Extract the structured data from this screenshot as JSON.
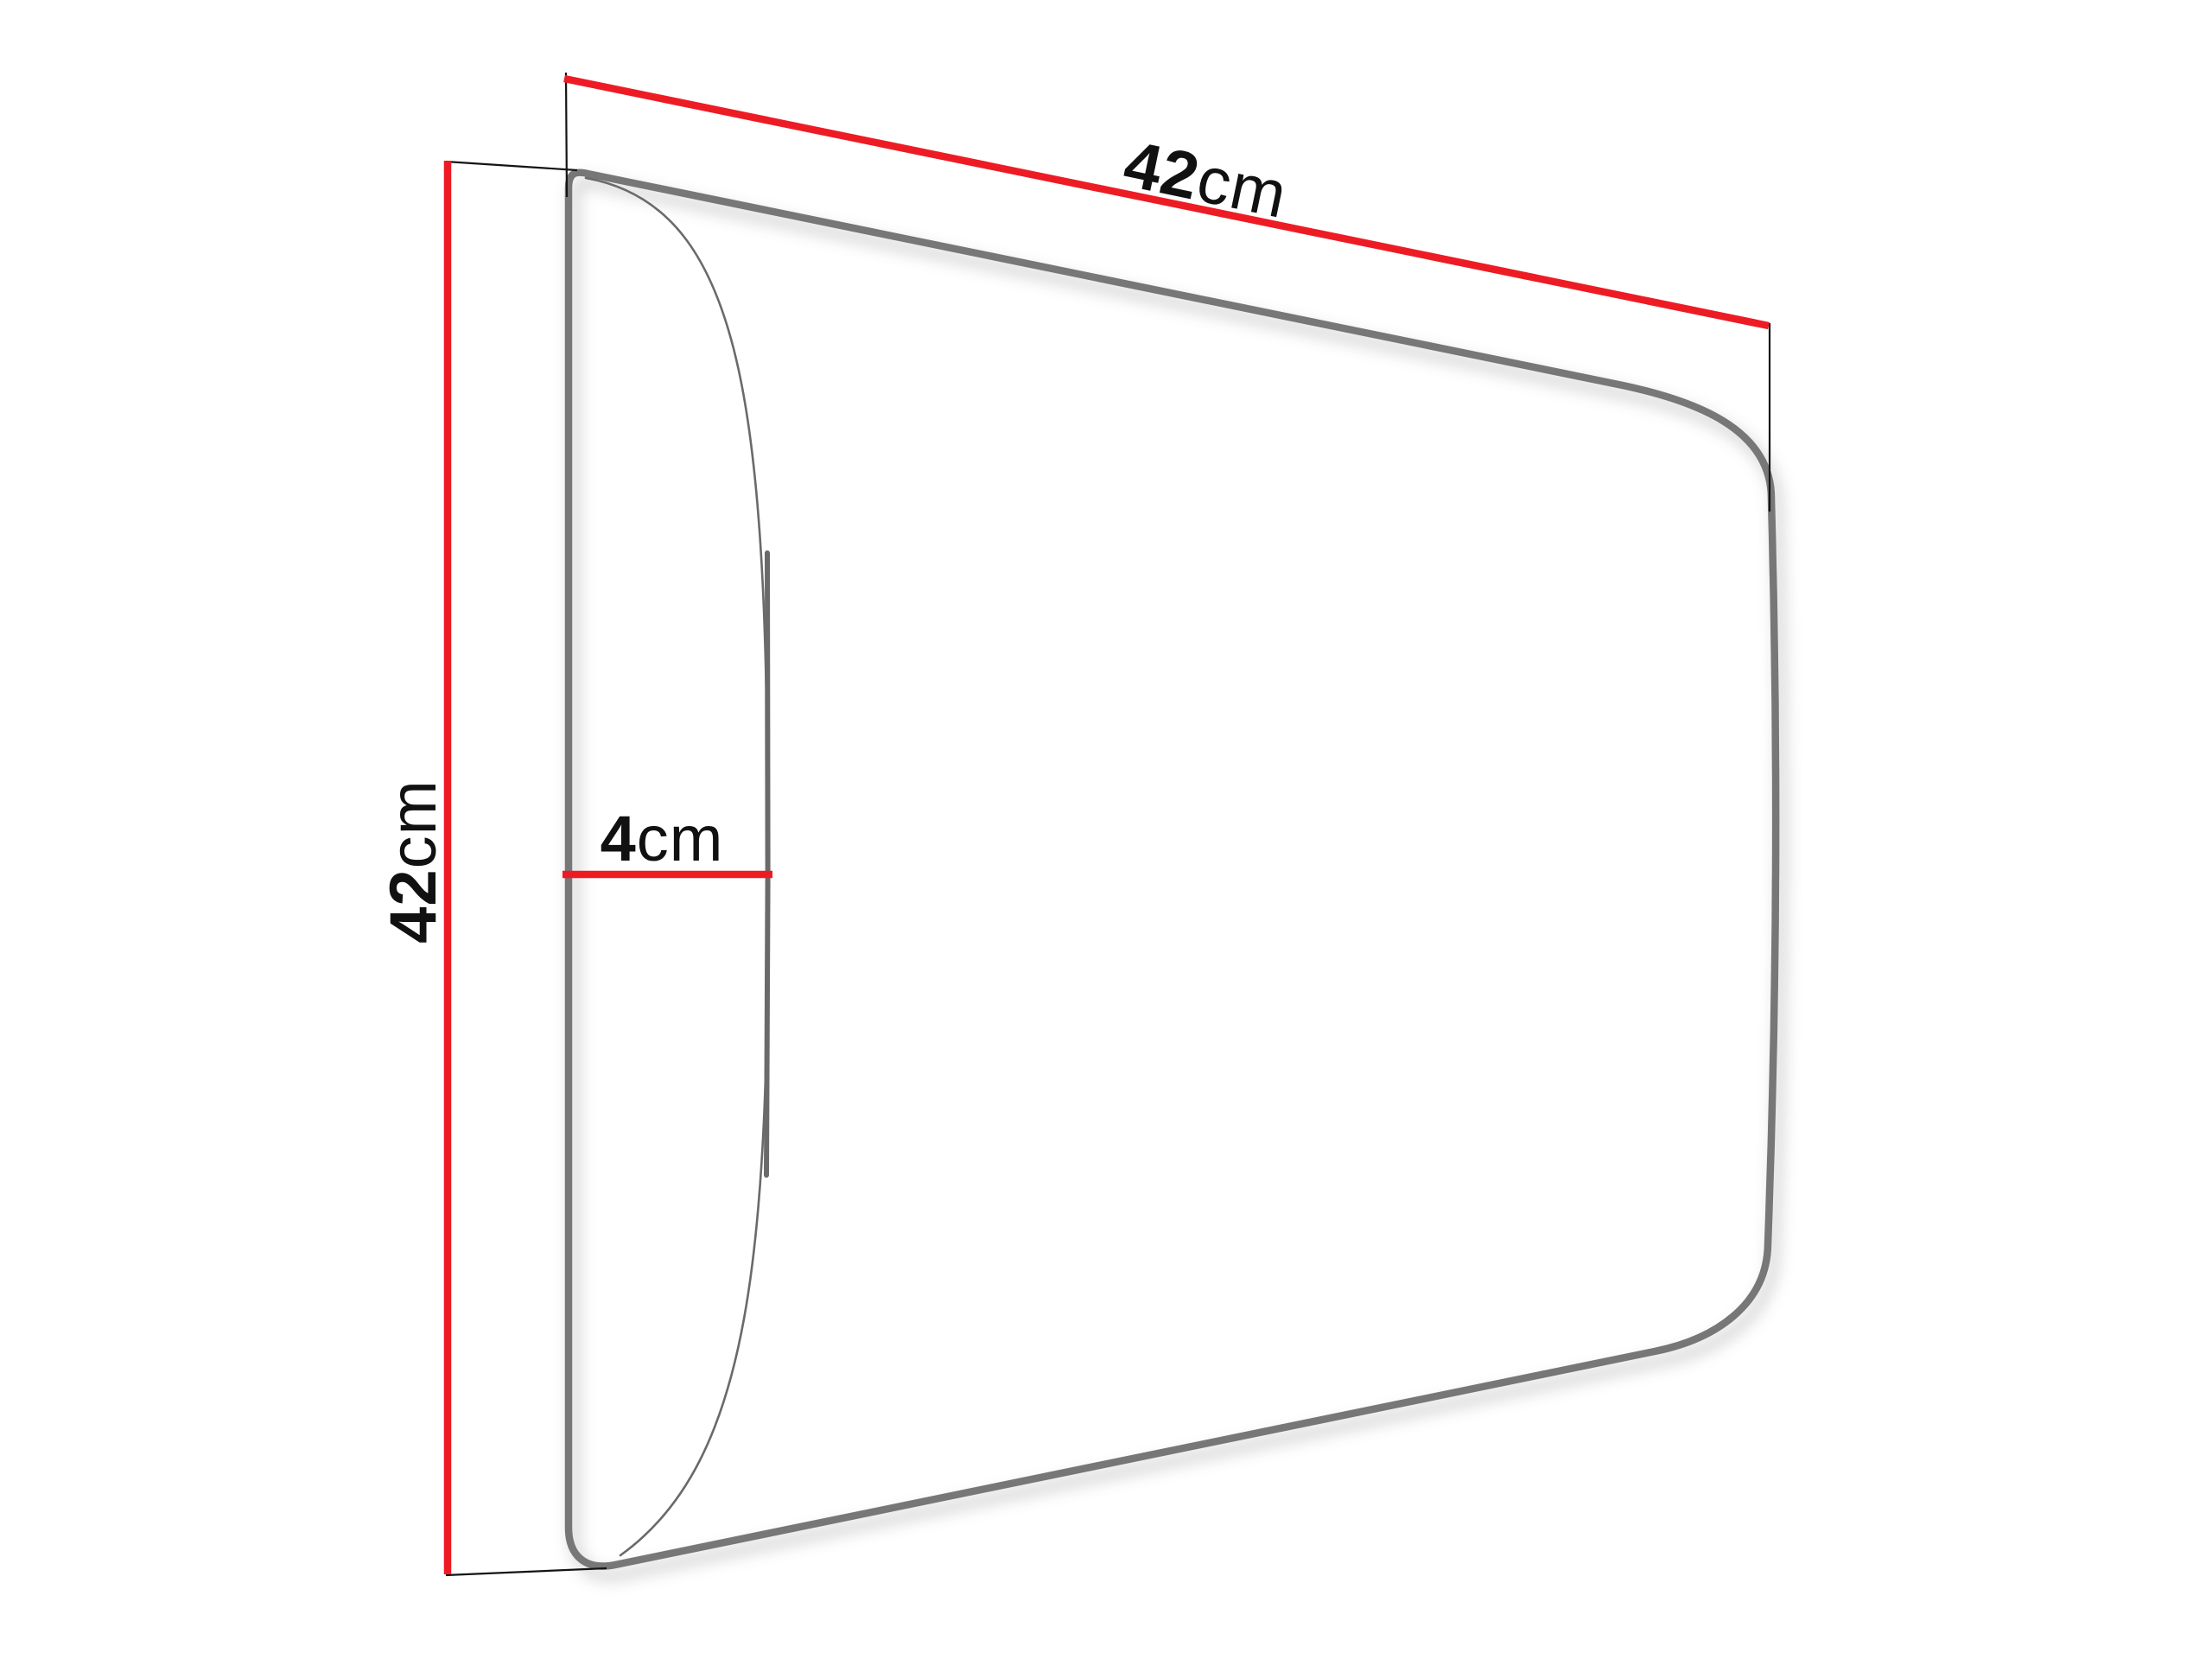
{
  "diagram": {
    "dimensions": {
      "width": {
        "value": "42",
        "unit": "cm"
      },
      "height": {
        "value": "42",
        "unit": "cm"
      },
      "depth": {
        "value": "4",
        "unit": "cm"
      }
    },
    "colors": {
      "dimension_line_red": "#ED1C24",
      "extension_line_black": "#141414",
      "panel_outline_gray": "#777777",
      "bulge_curve_gray": "#6a6a6a",
      "label_text": "#111111",
      "background": "#ffffff"
    }
  }
}
